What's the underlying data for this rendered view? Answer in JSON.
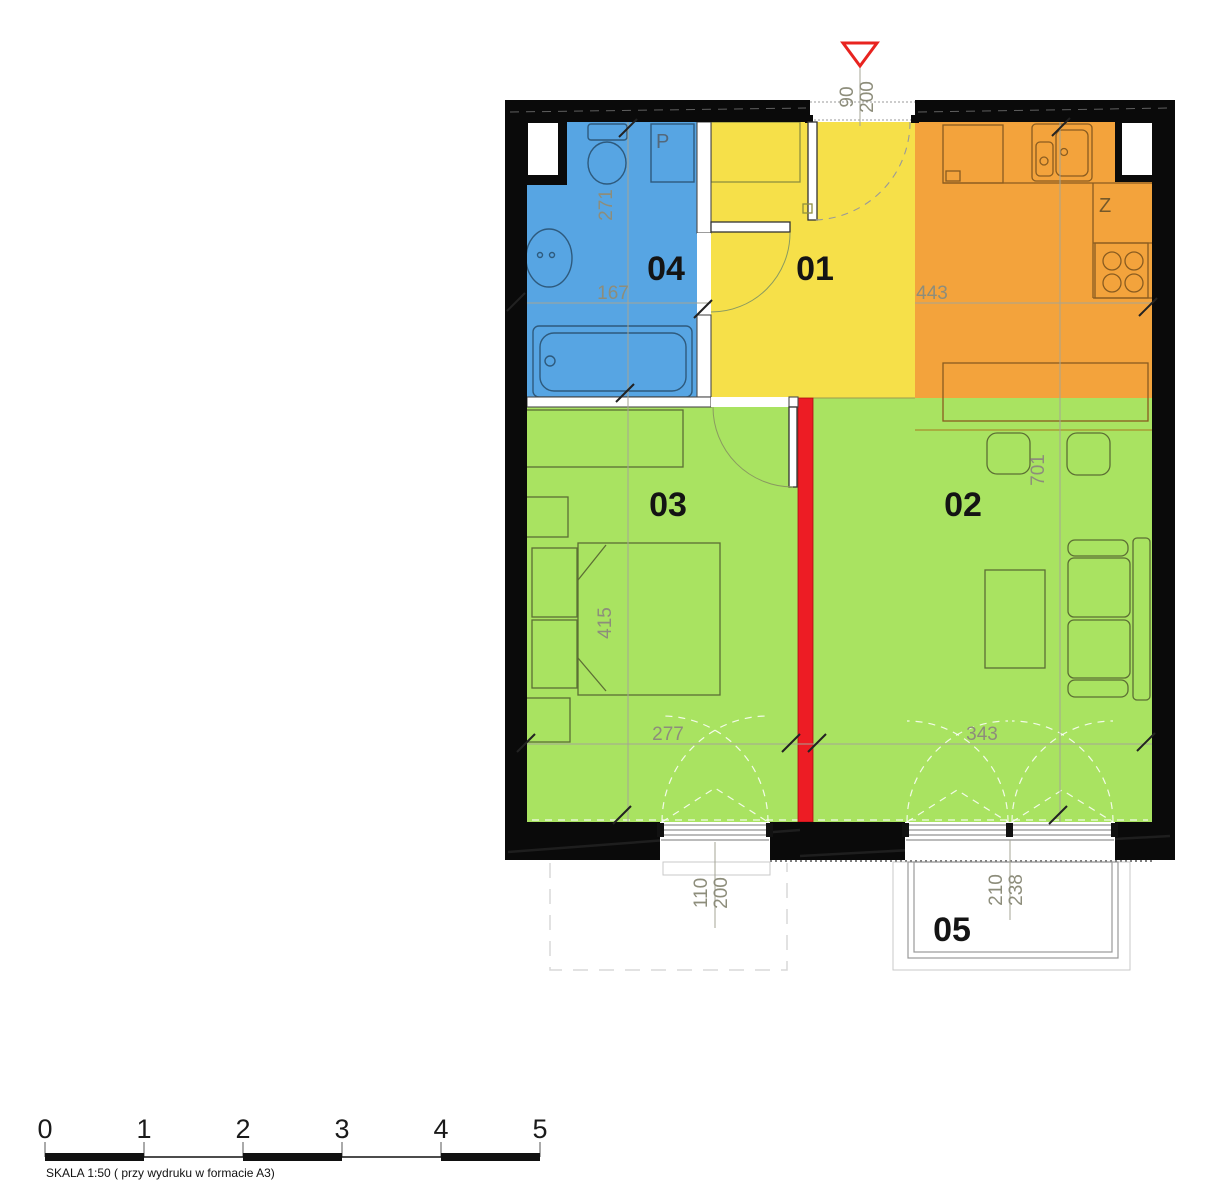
{
  "plan": {
    "rooms": [
      {
        "number": "01"
      },
      {
        "number": "02"
      },
      {
        "number": "03"
      },
      {
        "number": "04"
      },
      {
        "number": "05"
      }
    ],
    "annotations": {
      "washing_machine": "P",
      "kitchen": "Z"
    },
    "dimensions": {
      "bathroom_depth": "271",
      "bathroom_width": "167",
      "kitchen_width": "443",
      "bedroom_depth": "415",
      "bedroom_width": "277",
      "living_depth": "701",
      "living_width": "343",
      "entrance_door": {
        "width": "90",
        "height": "200"
      },
      "bedroom_window": {
        "width": "110",
        "height": "200"
      },
      "living_window": {
        "width": "210",
        "height": "238"
      }
    },
    "colors": {
      "bathroom": "#57a5e3",
      "hall": "#f6e049",
      "kitchen": "#f3a33c",
      "bedroom": "#a9e361",
      "living": "#a9e361",
      "wall": "#0a0a0a",
      "partition_red": "#ed1c24",
      "entrance_arrow": "#e8231f"
    }
  },
  "scale_bar": {
    "ticks": [
      "0",
      "1",
      "2",
      "3",
      "4",
      "5"
    ],
    "caption": "SKALA 1:50 ( przy wydruku w formacie A3)"
  }
}
